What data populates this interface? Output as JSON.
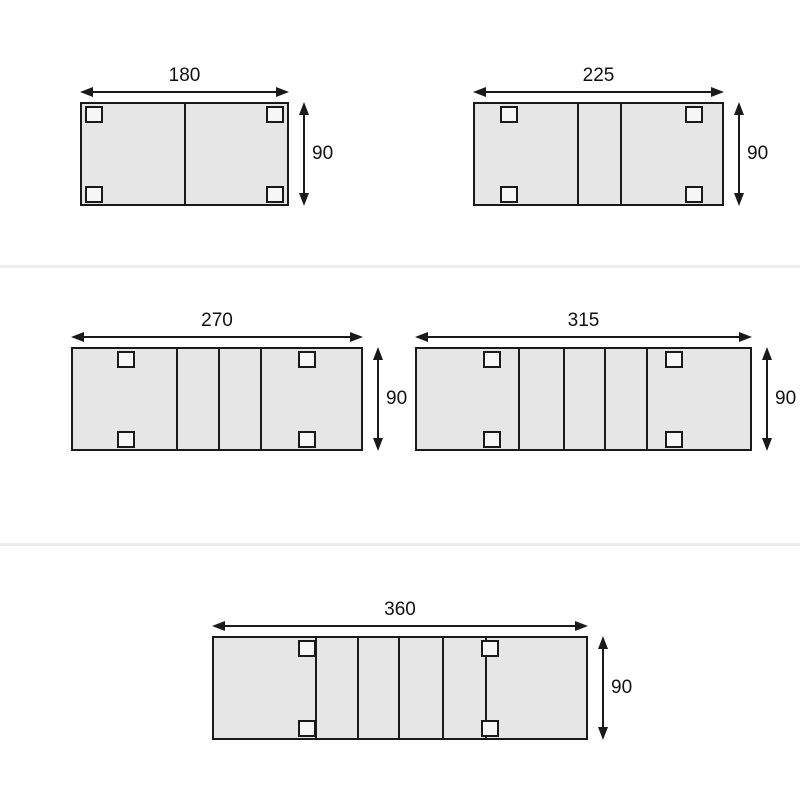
{
  "colors": {
    "background": "#ffffff",
    "outline": "#1a1a1a",
    "tabletop_fill": "#e6e6e6",
    "leg_fill": "#f7f7f7",
    "separator": "#ececec",
    "text": "#111111"
  },
  "leg_size": {
    "width": 18,
    "height": 17
  },
  "separators": [
    {
      "y": 265,
      "height": 3
    },
    {
      "y": 543,
      "height": 3
    }
  ],
  "diagrams": [
    {
      "width_label": "180",
      "height_label": "90",
      "box": {
        "left": 80,
        "top": 102,
        "width": 209,
        "height": 104
      },
      "dividers": [
        104
      ],
      "leg_x": [
        5,
        186
      ],
      "leg_y": [
        4,
        84
      ]
    },
    {
      "width_label": "225",
      "height_label": "90",
      "box": {
        "left": 473,
        "top": 102,
        "width": 251,
        "height": 104
      },
      "dividers": [
        104,
        147
      ],
      "leg_x": [
        27,
        212
      ],
      "leg_y": [
        4,
        84
      ]
    },
    {
      "width_label": "270",
      "height_label": "90",
      "box": {
        "left": 71,
        "top": 347,
        "width": 292,
        "height": 104
      },
      "dividers": [
        105,
        147,
        189
      ],
      "leg_x": [
        46,
        227
      ],
      "leg_y": [
        4,
        84
      ]
    },
    {
      "width_label": "315",
      "height_label": "90",
      "box": {
        "left": 415,
        "top": 347,
        "width": 337,
        "height": 104
      },
      "dividers": [
        103,
        148,
        189,
        231
      ],
      "leg_x": [
        68,
        250
      ],
      "leg_y": [
        4,
        84
      ]
    },
    {
      "width_label": "360",
      "height_label": "90",
      "box": {
        "left": 212,
        "top": 636,
        "width": 376,
        "height": 104
      },
      "dividers": [
        103,
        145,
        186,
        230,
        273
      ],
      "leg_x": [
        86,
        269
      ],
      "leg_y": [
        4,
        84
      ]
    }
  ]
}
